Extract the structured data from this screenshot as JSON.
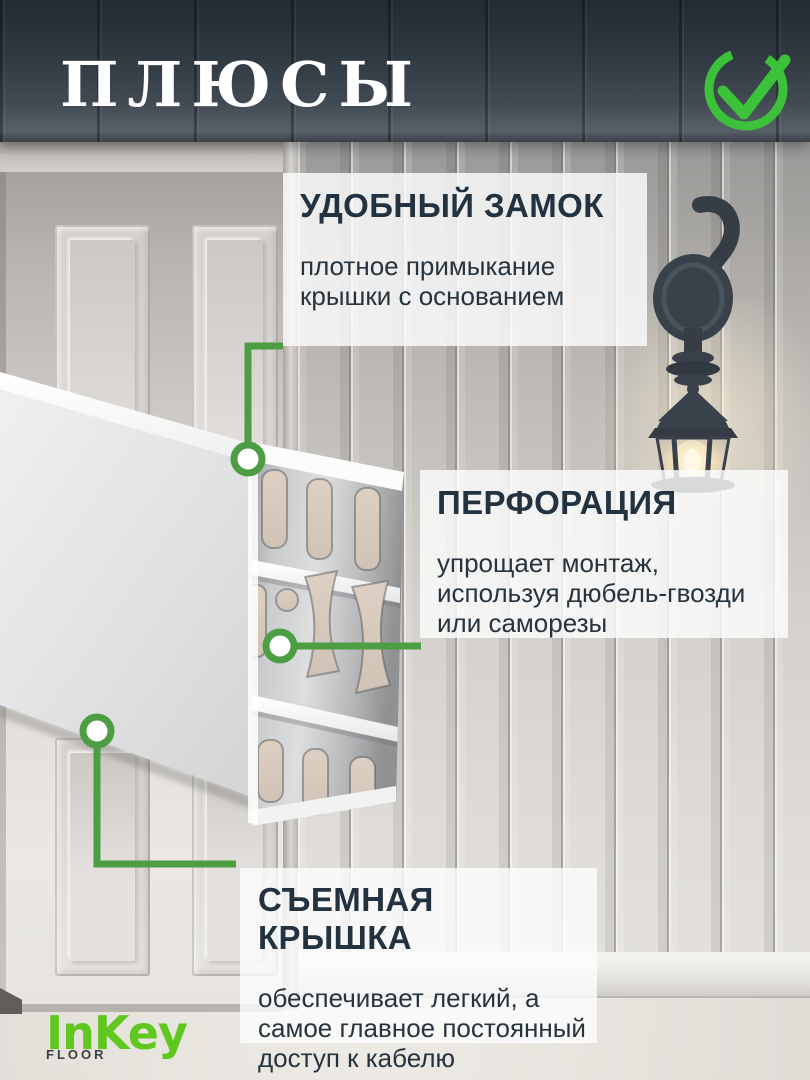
{
  "header": {
    "title": "ПЛЮСЫ"
  },
  "icons": {
    "header_check": "check-circle-icon",
    "lantern": "wall-lantern-icon"
  },
  "callouts": [
    {
      "id": "lock",
      "heading": "УДОБНЫЙ ЗАМОК",
      "body_lines": [
        "плотное примыкание",
        "крышки с основанием"
      ]
    },
    {
      "id": "perforation",
      "heading": "ПЕРФОРАЦИЯ",
      "body_lines": [
        "упрощает монтаж,",
        "используя дюбель-гвозди",
        "или саморезы"
      ]
    },
    {
      "id": "removable-cover",
      "heading": "СЪЕМНАЯ КРЫШКА",
      "body_lines": [
        "обеспечивает легкий, а",
        "самое главное постоянный",
        "доступ к кабелю"
      ]
    }
  ],
  "logo": {
    "name": "InKey",
    "sub": "FLOOR"
  },
  "colors": {
    "title_text": "#ffffff",
    "check_green": "#3cc23a",
    "connector_green": "#4c9d44",
    "callout_heading": "#233240",
    "callout_body": "#27333d",
    "callout_bg": "rgba(251,252,252,0.82)",
    "header_bg_top": "#232b33",
    "header_bg_bottom": "#575f67",
    "logo_green": "#5fc71e",
    "logo_sub_text": "#3e3f3f"
  }
}
